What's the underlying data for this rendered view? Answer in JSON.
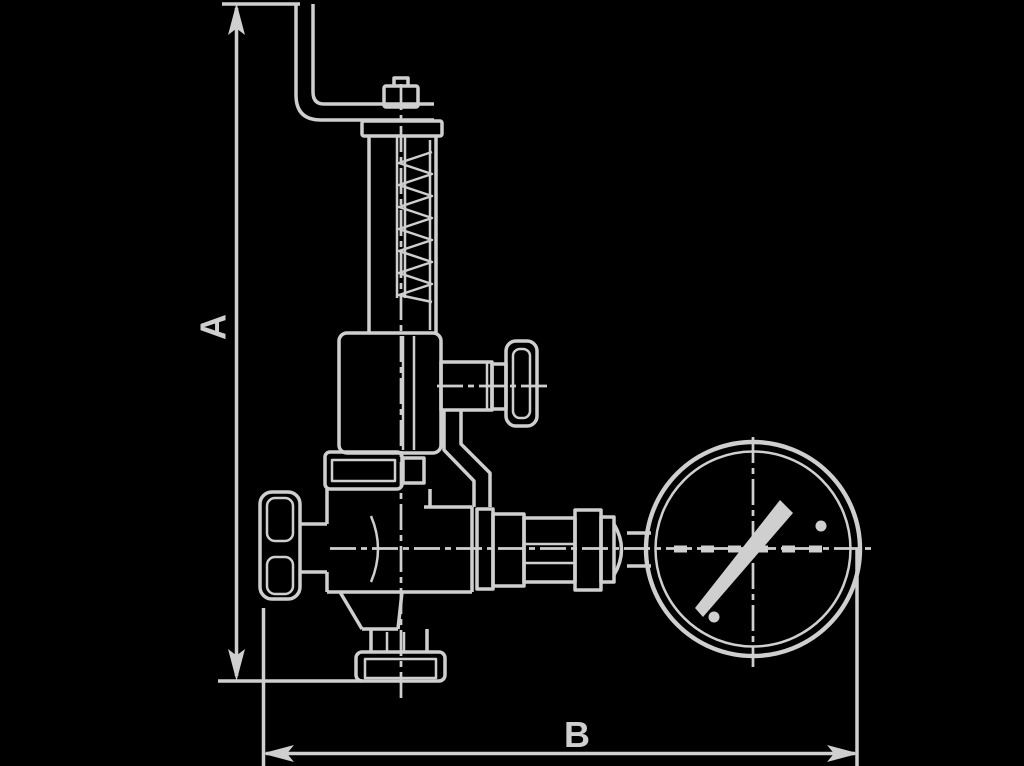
{
  "diagram": {
    "type": "technical-dimension-drawing",
    "subject": "safety-valve-with-pressure-gauge",
    "colors": {
      "background": "#000000",
      "line": "#cfcfcf"
    },
    "dimension_a": {
      "label": "A",
      "orientation": "vertical"
    },
    "dimension_b": {
      "label": "B",
      "orientation": "horizontal"
    },
    "parts": [
      "lever-handle",
      "adjusting-screw",
      "spring-bonnet",
      "spring-coil",
      "upper-body",
      "test-valve-knob",
      "union-nut",
      "handwheel",
      "valve-body",
      "bottom-flange",
      "pipe-fittings",
      "pressure-gauge",
      "gauge-needle"
    ]
  }
}
